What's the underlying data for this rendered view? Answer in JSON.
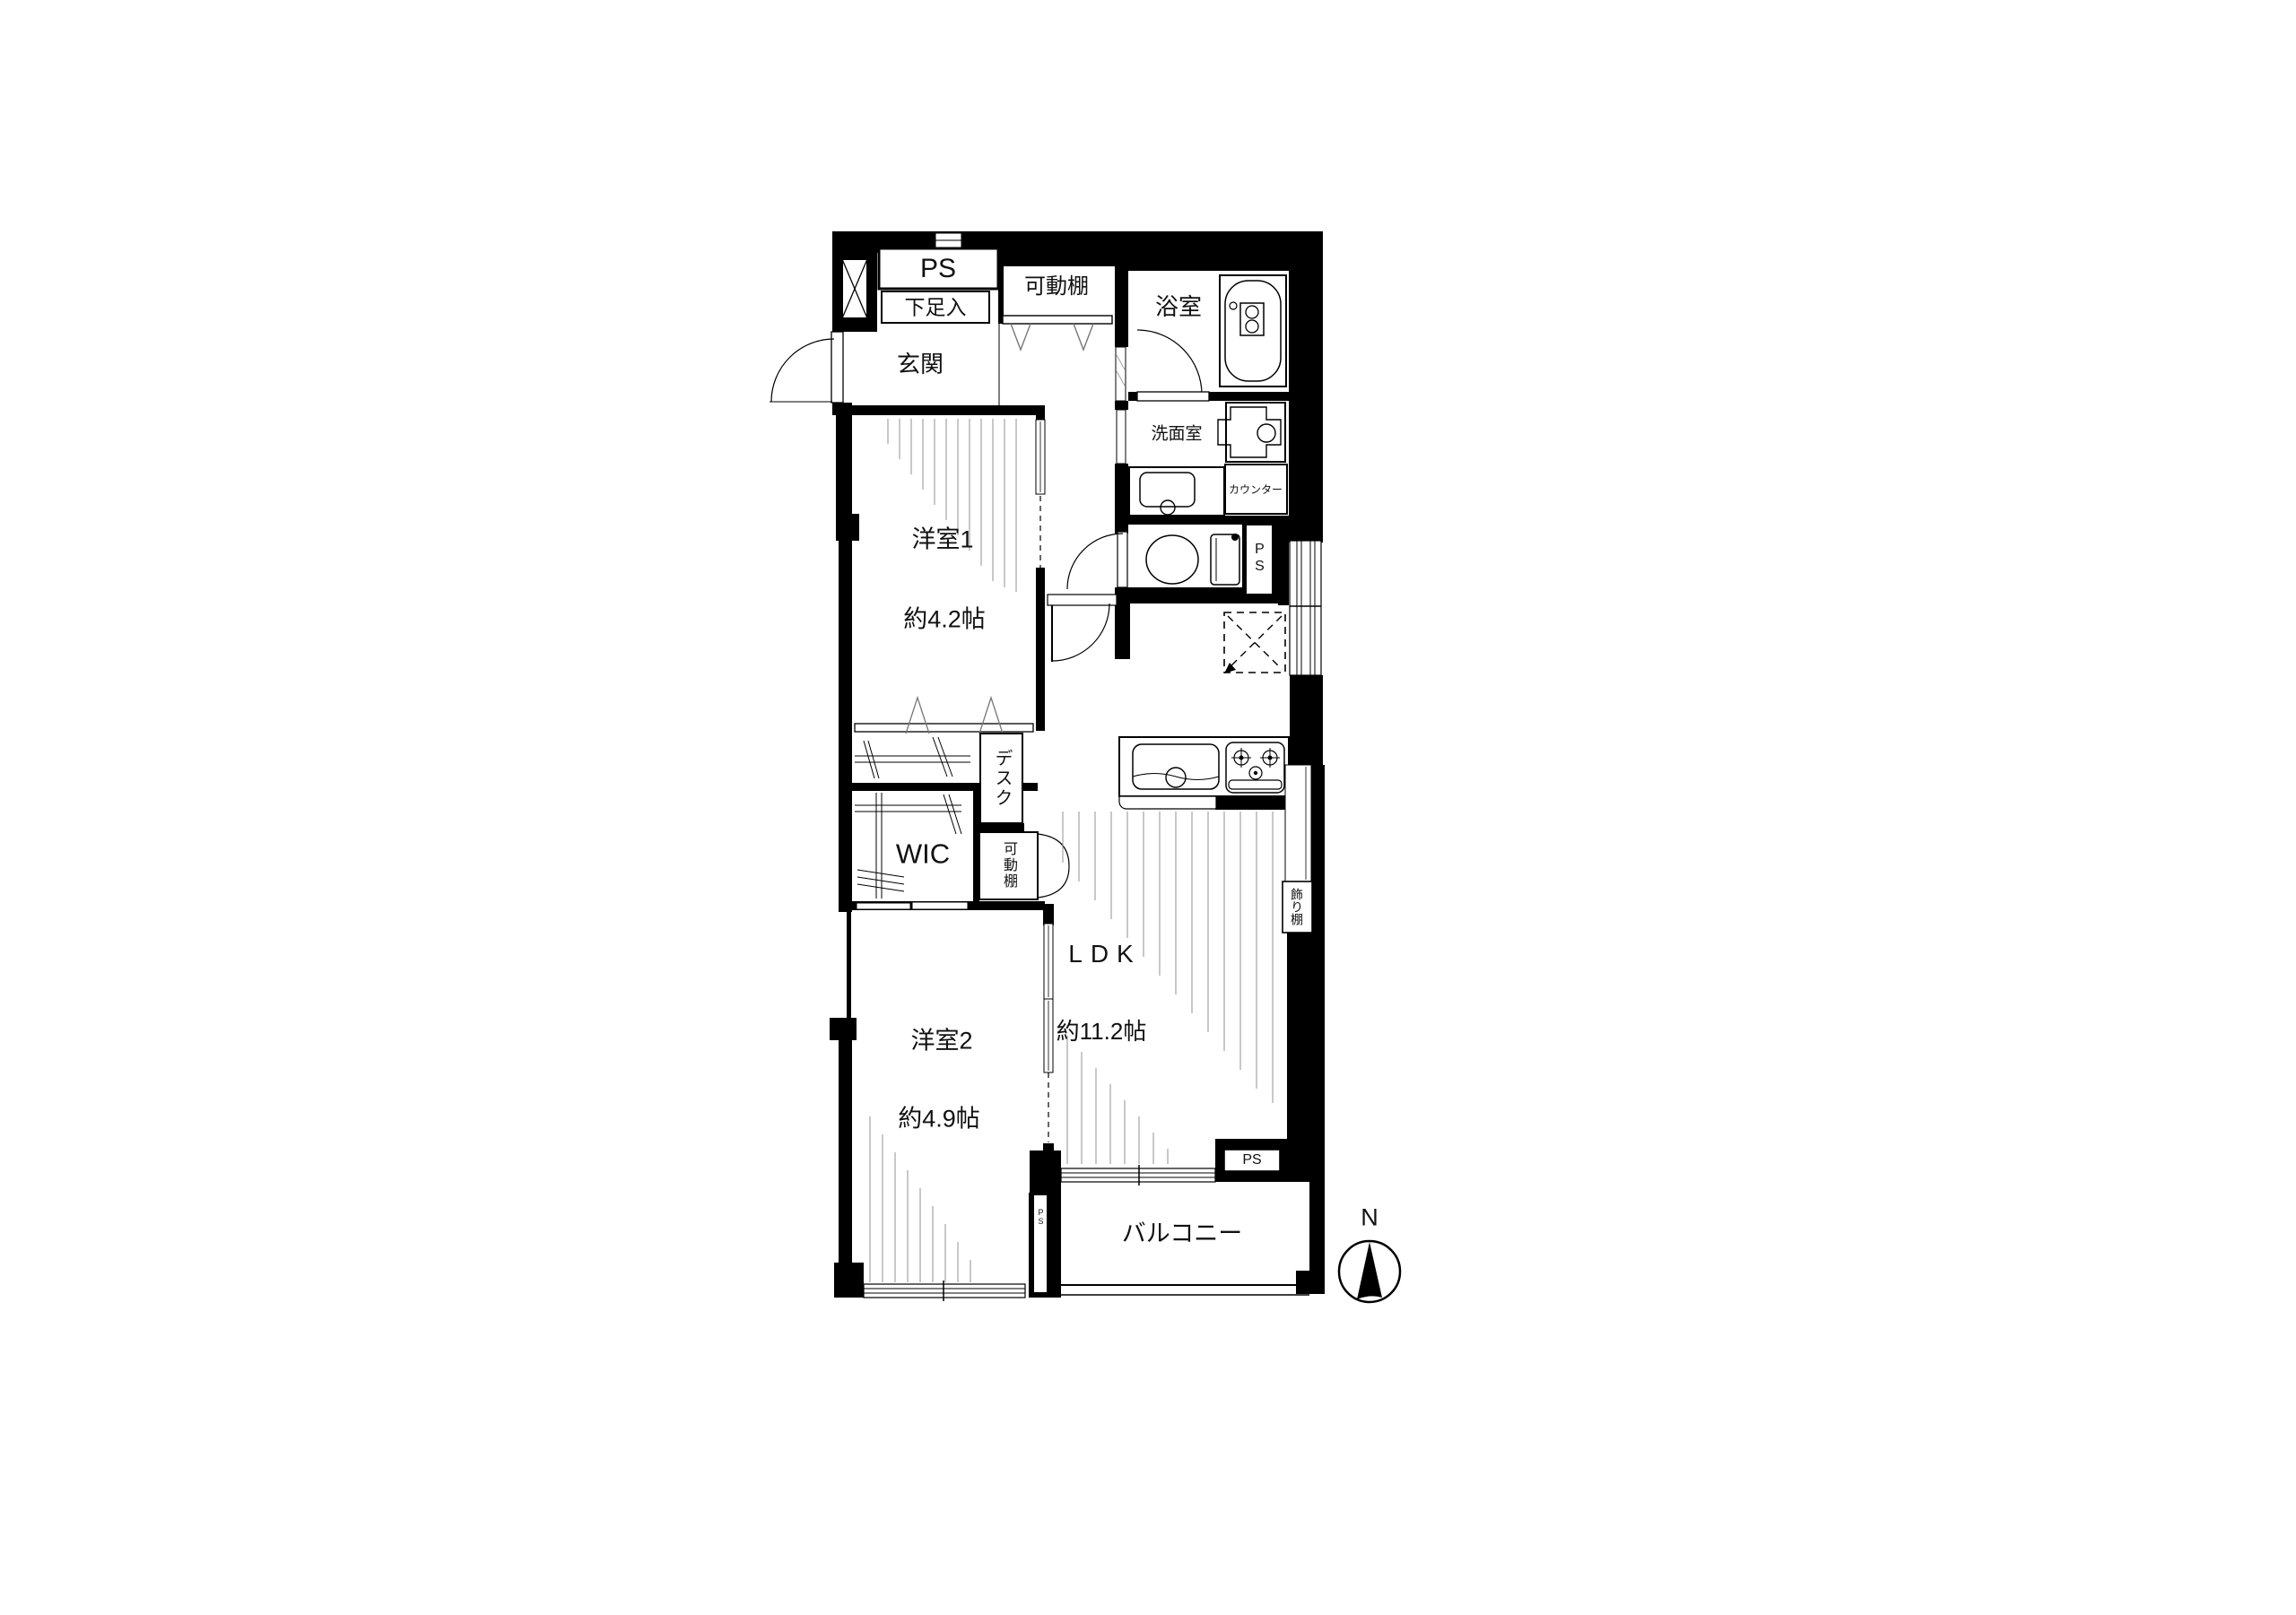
{
  "plan": {
    "labels": {
      "ps_top": "PS",
      "shoe_cabinet": "下足入",
      "entrance": "玄関",
      "movable_shelf_top": "可動棚",
      "bathroom": "浴室",
      "washroom": "洗面室",
      "counter": "カウンター",
      "ps_toilet": "PS",
      "room1_name": "洋室1",
      "room1_size": "約4.2帖",
      "desk": "デスク",
      "wic": "WIC",
      "movable_shelf_2": "可動棚",
      "room2_name": "洋室2",
      "room2_size": "約4.9帖",
      "ldk_name": "LDK",
      "ldk_size": "約11.2帖",
      "display_shelf": "飾り棚",
      "ps_ldk": "PS",
      "ps_column": "PS",
      "balcony": "バルコニー",
      "compass_north": "N"
    },
    "colors": {
      "wall": "#000000",
      "floor": "#ffffff",
      "hatch": "#909090"
    }
  }
}
